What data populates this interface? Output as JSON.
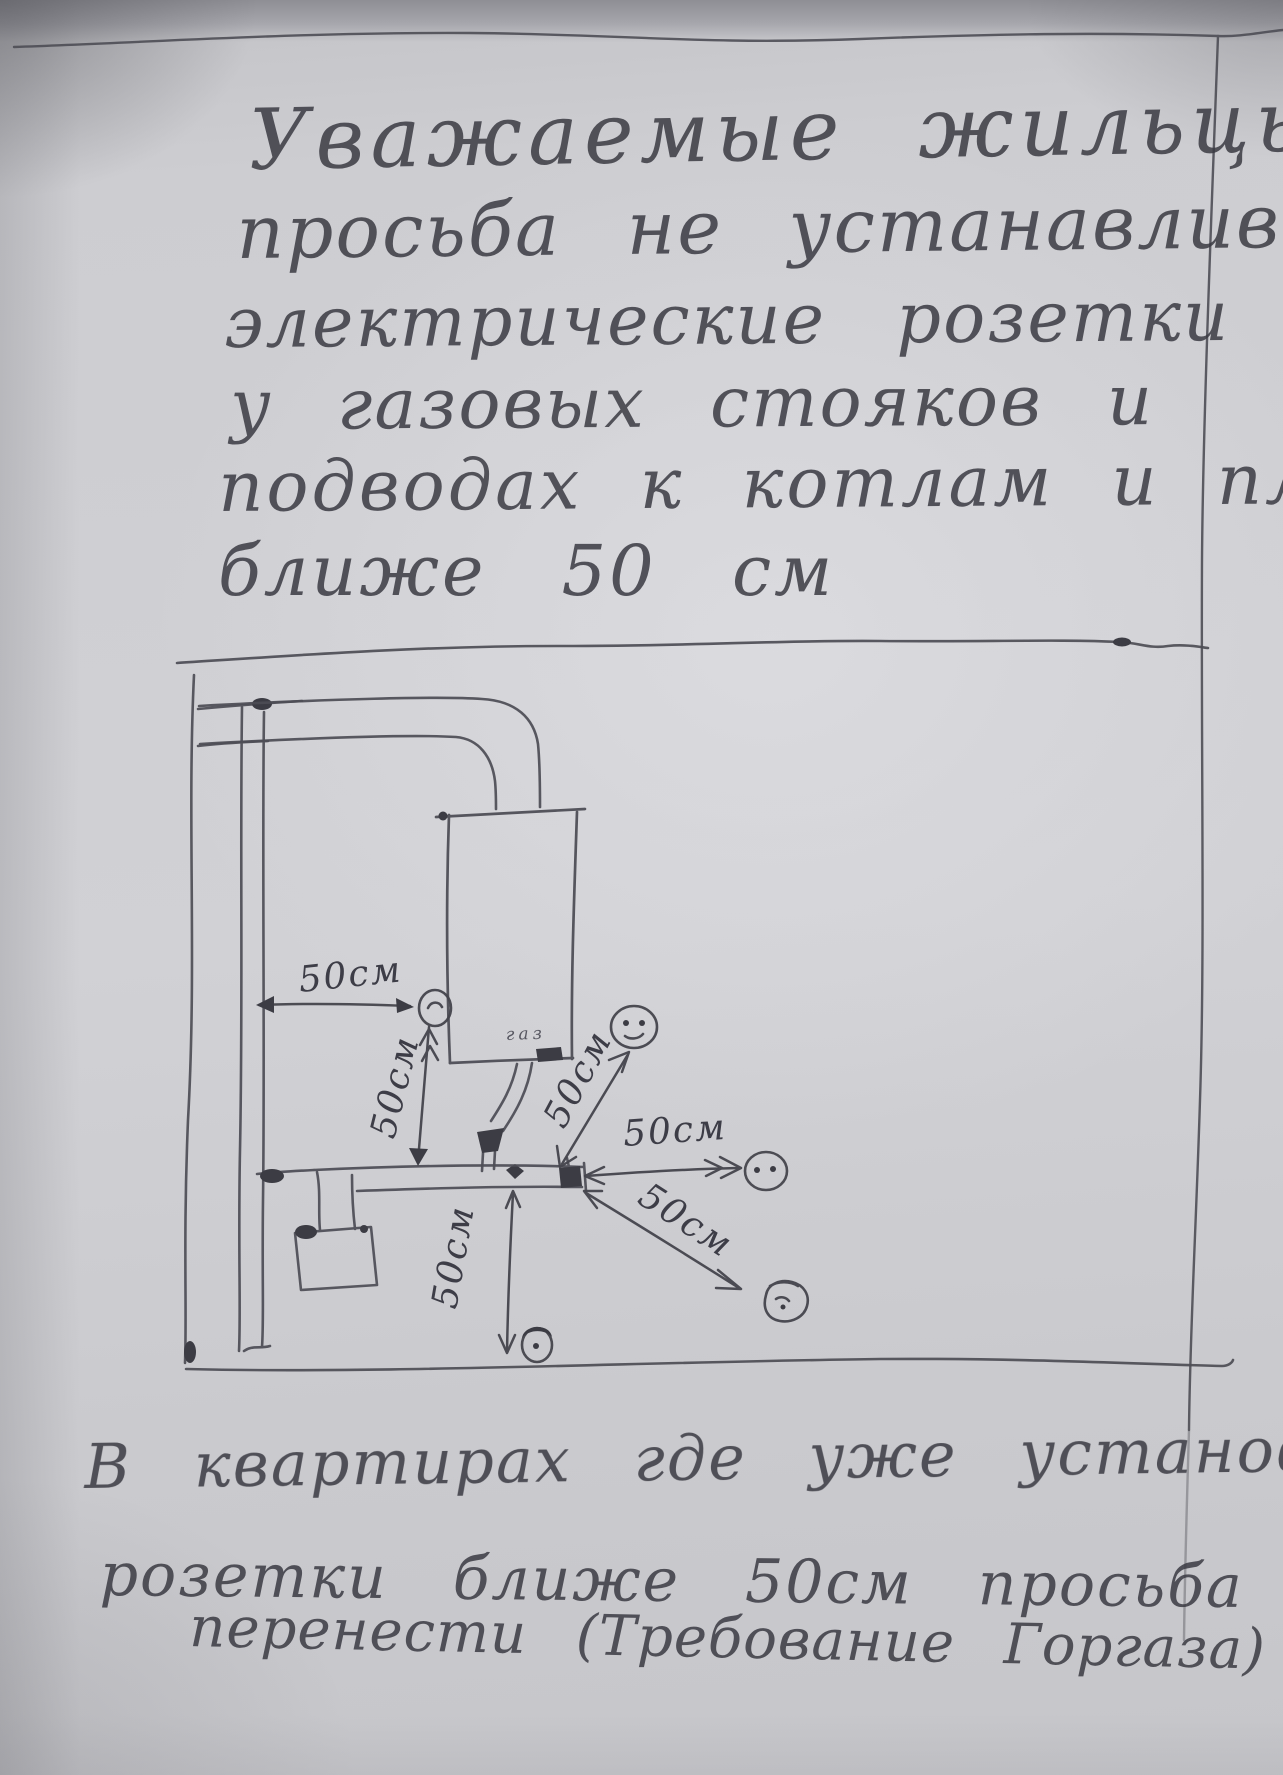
{
  "top_note": {
    "lines": [
      "Уважаемые жильцы",
      "просьба не устанавливать",
      "электрические розетки",
      "у газовых стояков и",
      "подводах к котлам и плитам",
      "ближе 50 см"
    ]
  },
  "bottom_note": {
    "lines": [
      "В квартирах где уже установлены",
      "розетки ближе 50см просьба их",
      "перенести (Требование Горгаза)"
    ]
  },
  "diagram": {
    "dimension_labels": [
      "50см",
      "50см",
      "50см",
      "50см",
      "50см",
      "50см"
    ],
    "boiler_label": "газ",
    "colors": {
      "ink": "#4d4d55",
      "paper": "#cdcdd1"
    }
  }
}
